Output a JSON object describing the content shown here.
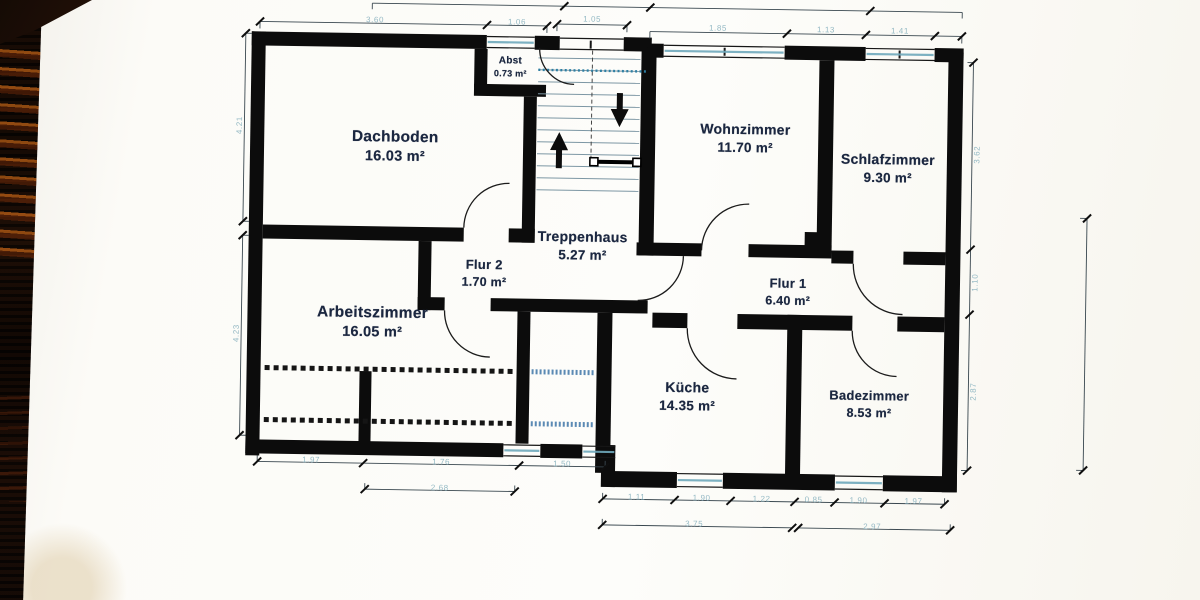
{
  "plan": {
    "rooms": [
      {
        "name": "Dachboden",
        "area": "16.03 m²"
      },
      {
        "name": "Abst",
        "area": "0.73 m²"
      },
      {
        "name": "Wohnzimmer",
        "area": "11.70 m²"
      },
      {
        "name": "Schlafzimmer",
        "area": "9.30 m²"
      },
      {
        "name": "Treppenhaus",
        "area": "5.27 m²"
      },
      {
        "name": "Flur 2",
        "area": "1.70 m²"
      },
      {
        "name": "Flur 1",
        "area": "6.40 m²"
      },
      {
        "name": "Arbeitszimmer",
        "area": "16.05 m²"
      },
      {
        "name": "Küche",
        "area": "14.35 m²"
      },
      {
        "name": "Badezimmer",
        "area": "8.53 m²"
      }
    ],
    "dimensions": {
      "top": [
        "3.60",
        "1.06",
        "1.05",
        "1.85",
        "1.13",
        "1.41"
      ],
      "left": [
        "4.21",
        "4.23"
      ],
      "right": [
        "3.62",
        "1.10",
        "2.87"
      ],
      "bottom_left_row1": [
        "1.97",
        "1.76",
        "1.50"
      ],
      "bottom_left_row2": [
        "2.68"
      ],
      "bottom_right_row1": [
        "1.11",
        "1.90",
        "1.22",
        "0.85",
        "1.90",
        "1.97"
      ],
      "bottom_right_row2": [
        "3.75",
        "2.97"
      ]
    }
  },
  "colors": {
    "wall": "#0c0c0c",
    "label_text": "#1b2740",
    "dimension_text": "#8fb6c2",
    "window_line": "#6fa9bc",
    "knee_wall_blue": "#3f76a8",
    "paper": "#fcfbf7",
    "photo_border": "#140a05",
    "ember_orange": "#d86e18"
  }
}
